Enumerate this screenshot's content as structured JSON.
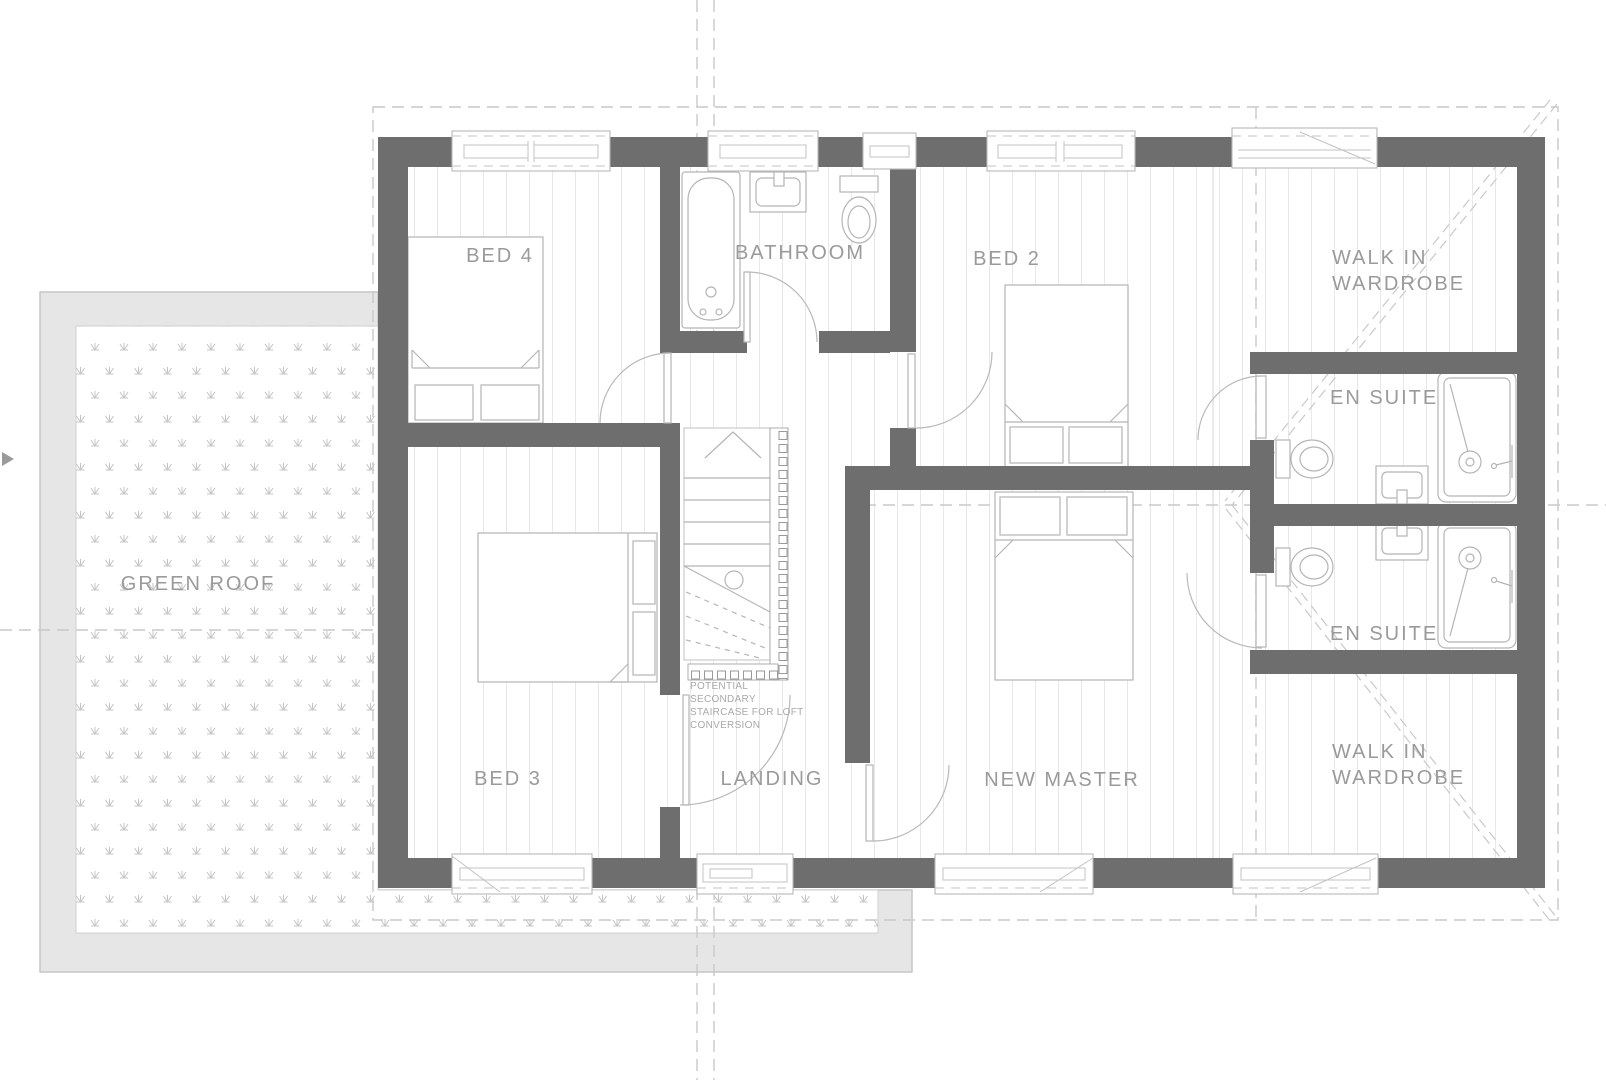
{
  "rooms": {
    "bed4": "BED 4",
    "bathroom": "BATHROOM",
    "bed2": "BED 2",
    "wiw_top_l1": "WALK IN",
    "wiw_top_l2": "WARDROBE",
    "ensuite_top": "EN SUITE",
    "ensuite_bottom": "EN SUITE",
    "green_roof": "GREEN ROOF",
    "bed3": "BED 3",
    "landing": "LANDING",
    "new_master": "NEW MASTER",
    "wiw_bottom_l1": "WALK IN",
    "wiw_bottom_l2": "WARDROBE"
  },
  "note": {
    "lines": [
      "POTENTIAL",
      "SECONDARY",
      "STAIRCASE FOR LOFT",
      "CONVERSION"
    ]
  },
  "colors": {
    "wall": "#6e6e6e",
    "line": "#b5b5b5",
    "hatch": "#e8e8e8",
    "dashed": "#c9c9c9",
    "label": "#9a9a9a",
    "note": "#a9a9a9",
    "roof_band": "#e6e6e6",
    "band_stroke": "#c6c6c6",
    "roof_dot": "#c4c4c4"
  }
}
